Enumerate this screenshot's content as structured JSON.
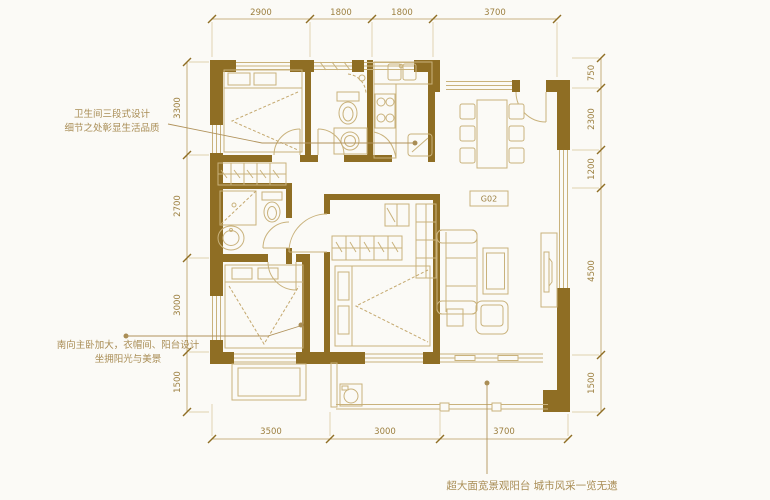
{
  "colors": {
    "wall": "#8f6e24",
    "furniture_line": "#c9b27c",
    "dimension": "#9c7f3f",
    "annotation": "#a98d55",
    "background": "#fbfaf6"
  },
  "dimensions": {
    "top": [
      "2900",
      "1800",
      "1800",
      "3700"
    ],
    "bottom": [
      "3500",
      "3000",
      "3700"
    ],
    "left": [
      "3300",
      "2700",
      "3000",
      "1500"
    ],
    "right": [
      "750",
      "2300",
      "1200",
      "4500",
      "1500"
    ]
  },
  "labels": {
    "unit_box": "G02"
  },
  "annotations": {
    "bathroom": {
      "line1": "卫生间三段式设计",
      "line2": "细节之处彰显生活品质"
    },
    "bedroom": {
      "line1": "南向主卧加大，衣帽间、阳台设计",
      "line2": "坐拥阳光与美景"
    },
    "balcony": {
      "text": "超大面宽景观阳台 城市风采一览无遗"
    }
  }
}
